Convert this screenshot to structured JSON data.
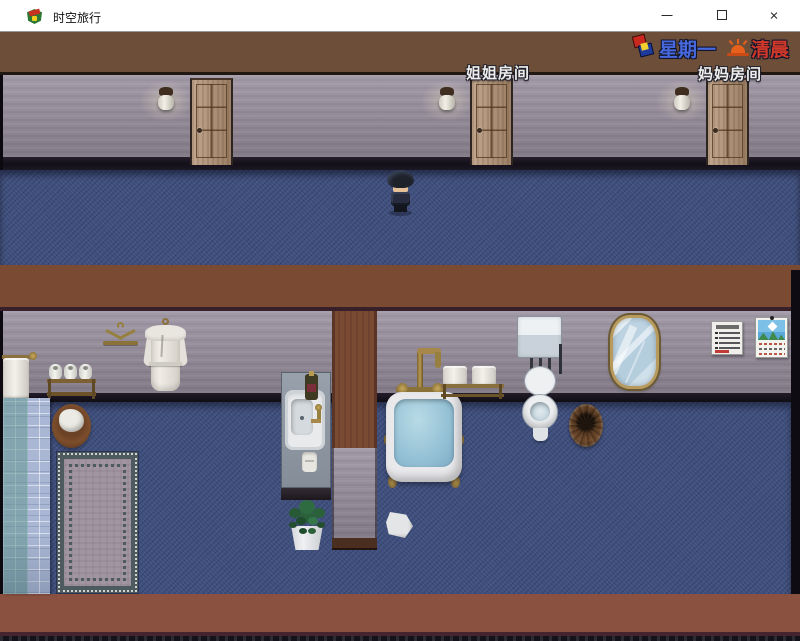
{
  "window": {
    "title": "时空旅行",
    "close_glyph": "×"
  },
  "hud": {
    "day": "星期一",
    "time": "清晨",
    "day_color": "#4868de",
    "time_color": "#d0382a",
    "day_icon": "calendar-dice-icon",
    "time_icon": "sunrise-icon"
  },
  "room_labels": {
    "sister": "姐姐房间",
    "mother": "妈妈房间"
  },
  "palette": {
    "wall": "#988f9e",
    "carpet": "#40507e",
    "wood_band_top": "#6d4e39",
    "wood_band_mid": "#7b4a33",
    "wood_band_bottom": "#8a5140",
    "door_wood": "#b49375",
    "bath_water": "#8fbcd2"
  }
}
